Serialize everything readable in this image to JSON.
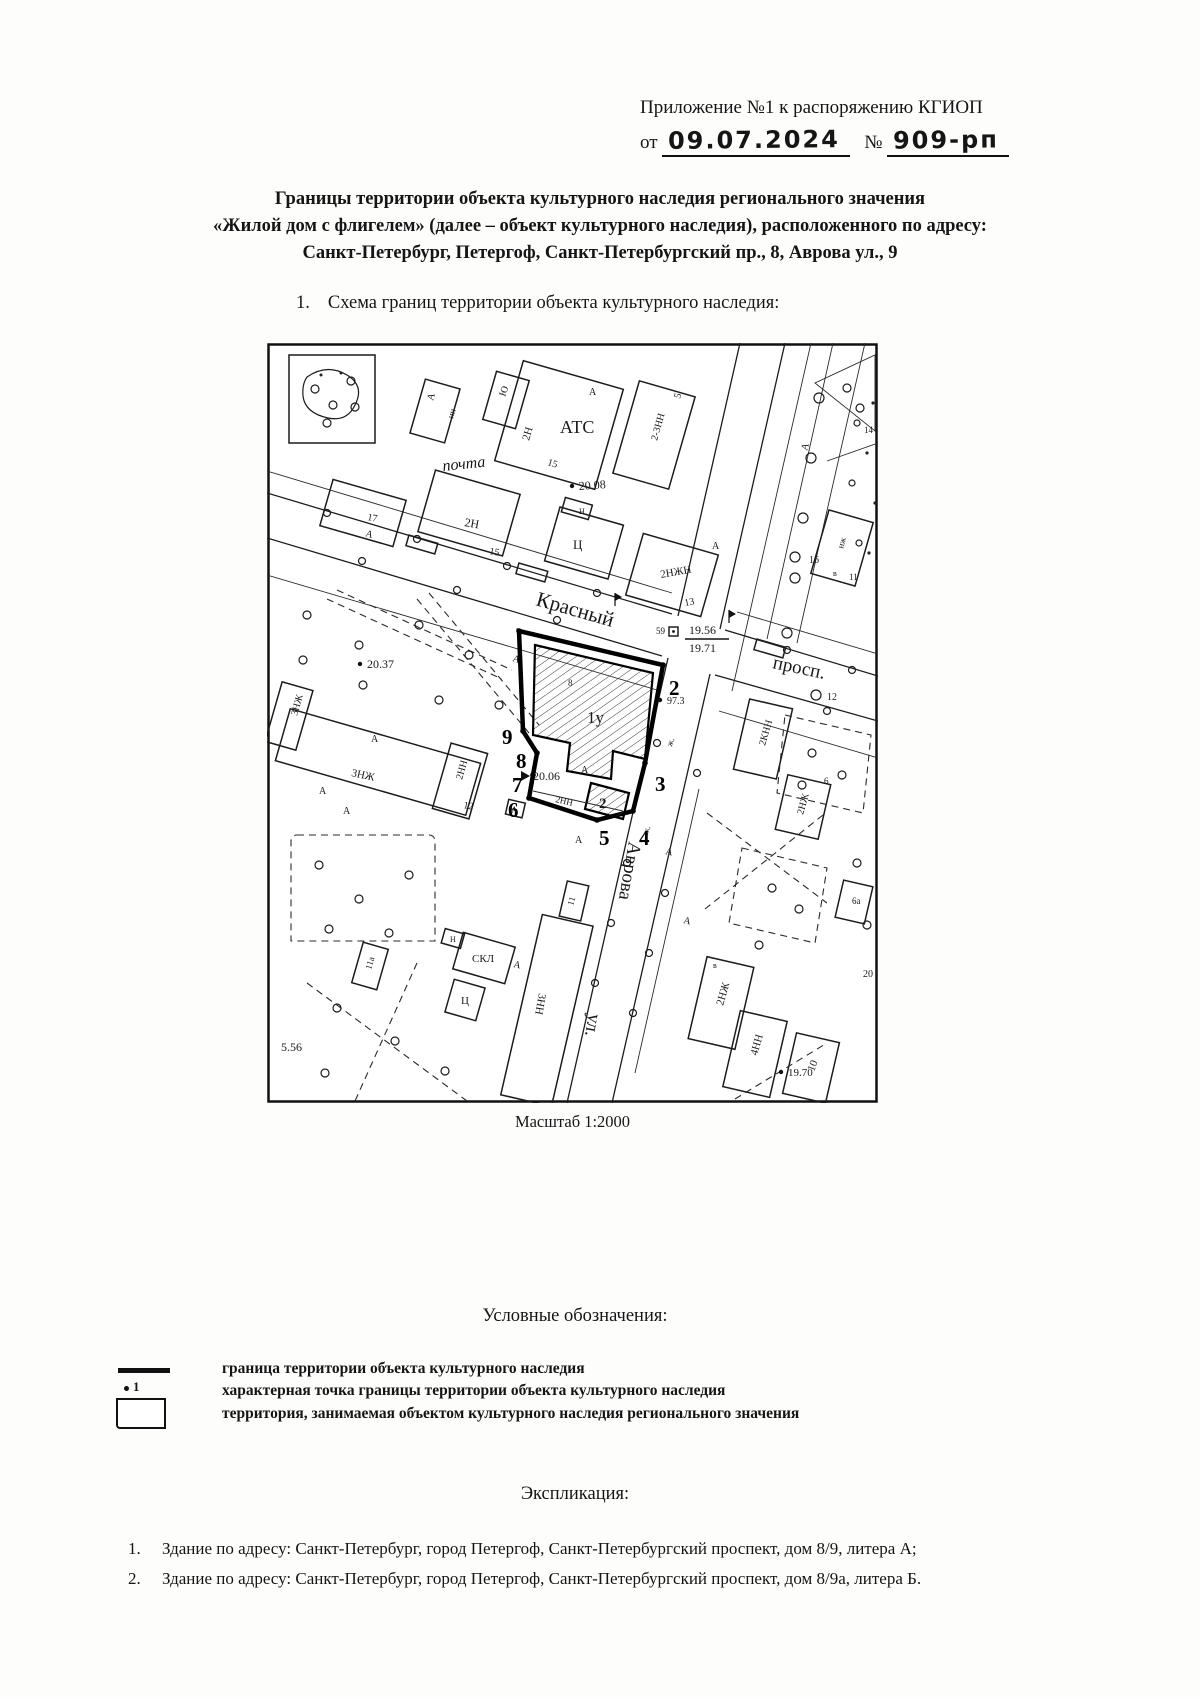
{
  "header": {
    "line1": "Приложение №1 к распоряжению КГИОП",
    "from_label": "от",
    "date_value": "09.07.2024",
    "number_label": "№",
    "number_value": "909-рп"
  },
  "title": {
    "line1": "Границы территории объекта культурного наследия регионального значения",
    "line2": "«Жилой дом с флигелем» (далее – объект культурного наследия), расположенного по адресу:",
    "line3": "Санкт-Петербург, Петергоф, Санкт-Петербургский пр., 8, Аврова ул., 9"
  },
  "section1": {
    "number": "1.",
    "text": "Схема границ территории объекта культурного наследия:"
  },
  "map": {
    "caption": "Масштаб 1:2000",
    "labels": [
      {
        "t": "Красный",
        "x": 268,
        "y": 262,
        "r": 16,
        "s": 21
      },
      {
        "t": "просп.",
        "x": 505,
        "y": 325,
        "r": 12,
        "s": 19
      },
      {
        "t": "Аврова",
        "x": 362,
        "y": 498,
        "r": 100,
        "s": 19
      },
      {
        "t": "ул.",
        "x": 322,
        "y": 670,
        "r": 100,
        "s": 19
      },
      {
        "t": "АТС",
        "x": 293,
        "y": 90,
        "s": 18
      },
      {
        "t": "почта",
        "x": 176,
        "y": 128,
        "r": -6,
        "s": 16,
        "i": true
      },
      {
        "t": "2Н",
        "x": 262,
        "y": 98,
        "r": -74,
        "s": 11
      },
      {
        "t": "А",
        "x": 322,
        "y": 52,
        "s": 10
      },
      {
        "t": "2-3НН",
        "x": 390,
        "y": 98,
        "r": -74,
        "s": 10
      },
      {
        "t": "5",
        "x": 413,
        "y": 56,
        "r": -74,
        "s": 10
      },
      {
        "t": "15",
        "x": 280,
        "y": 122,
        "r": 16,
        "s": 10
      },
      {
        "t": "20.08",
        "x": 312,
        "y": 147,
        "r": -4,
        "s": 12,
        "m": "dot"
      },
      {
        "t": "2Н",
        "x": 197,
        "y": 183,
        "r": 10,
        "s": 12
      },
      {
        "t": "15",
        "x": 222,
        "y": 211,
        "r": 10,
        "s": 10
      },
      {
        "t": "17",
        "x": 100,
        "y": 177,
        "r": 10,
        "s": 10
      },
      {
        "t": "Ю",
        "x": 238,
        "y": 54,
        "r": -70,
        "s": 10
      },
      {
        "t": "нн",
        "x": 186,
        "y": 76,
        "r": -74,
        "s": 9
      },
      {
        "t": "А",
        "x": 166,
        "y": 58,
        "r": -74,
        "s": 10
      },
      {
        "t": "Ц",
        "x": 306,
        "y": 206,
        "s": 13
      },
      {
        "t": "Н",
        "x": 312,
        "y": 171,
        "s": 8
      },
      {
        "t": "2НЖН",
        "x": 394,
        "y": 235,
        "r": -10,
        "s": 11
      },
      {
        "t": "13",
        "x": 418,
        "y": 263,
        "r": -10,
        "s": 10
      },
      {
        "t": "А",
        "x": 445,
        "y": 206,
        "s": 10
      },
      {
        "t": "14",
        "x": 597,
        "y": 90,
        "s": 9
      },
      {
        "t": "А",
        "x": 540,
        "y": 108,
        "r": -74,
        "s": 10
      },
      {
        "t": "нж",
        "x": 576,
        "y": 206,
        "r": -74,
        "s": 9
      },
      {
        "t": "в",
        "x": 566,
        "y": 233,
        "s": 8
      },
      {
        "t": "11",
        "x": 582,
        "y": 237,
        "s": 9
      },
      {
        "t": "16",
        "x": 542,
        "y": 220,
        "s": 10
      },
      {
        "t": "А",
        "x": 98,
        "y": 193,
        "r": 16,
        "s": 10
      },
      {
        "t": "А",
        "x": 245,
        "y": 318,
        "r": 16,
        "s": 10
      },
      {
        "t": "12",
        "x": 560,
        "y": 357,
        "s": 10
      },
      {
        "t": "2КНН",
        "x": 498,
        "y": 403,
        "r": -74,
        "s": 10
      },
      {
        "t": "2НЖ",
        "x": 536,
        "y": 472,
        "r": -74,
        "s": 10
      },
      {
        "t": "6",
        "x": 557,
        "y": 441,
        "s": 9
      },
      {
        "t": "6а",
        "x": 585,
        "y": 561,
        "s": 9
      },
      {
        "t": "2НЖ",
        "x": 456,
        "y": 663,
        "r": -74,
        "s": 11
      },
      {
        "t": "в",
        "x": 446,
        "y": 625,
        "s": 8
      },
      {
        "t": "4НН",
        "x": 490,
        "y": 713,
        "r": -74,
        "s": 11
      },
      {
        "t": "10",
        "x": 547,
        "y": 729,
        "r": -70,
        "s": 11
      },
      {
        "t": "19.70",
        "x": 521,
        "y": 733,
        "s": 11,
        "m": "dot"
      },
      {
        "t": "20",
        "x": 596,
        "y": 634,
        "s": 10
      },
      {
        "t": "А",
        "x": 416,
        "y": 580,
        "r": 12,
        "s": 10
      },
      {
        "t": "20.37",
        "x": 100,
        "y": 325,
        "s": 12,
        "m": "dot"
      },
      {
        "t": "3НЖ",
        "x": 30,
        "y": 373,
        "r": -74,
        "s": 10
      },
      {
        "t": "3НЖ",
        "x": 84,
        "y": 433,
        "r": 12,
        "s": 11
      },
      {
        "t": "2НН",
        "x": 195,
        "y": 437,
        "r": -74,
        "s": 10
      },
      {
        "t": "12",
        "x": 196,
        "y": 465,
        "r": 10,
        "s": 10
      },
      {
        "t": "А",
        "x": 104,
        "y": 399,
        "s": 10
      },
      {
        "t": "А",
        "x": 52,
        "y": 451,
        "s": 10
      },
      {
        "t": "А",
        "x": 76,
        "y": 471,
        "s": 10
      },
      {
        "t": "5.56",
        "x": 14,
        "y": 708,
        "s": 12
      },
      {
        "t": "СКЛ",
        "x": 205,
        "y": 619,
        "s": 11
      },
      {
        "t": "Н",
        "x": 183,
        "y": 599,
        "s": 8
      },
      {
        "t": "Ц",
        "x": 194,
        "y": 661,
        "s": 11
      },
      {
        "t": "11а",
        "x": 104,
        "y": 627,
        "r": -74,
        "s": 9
      },
      {
        "t": "3НН",
        "x": 272,
        "y": 650,
        "r": 100,
        "s": 11
      },
      {
        "t": "11",
        "x": 306,
        "y": 563,
        "r": -74,
        "s": 9
      },
      {
        "t": "А",
        "x": 246,
        "y": 624,
        "r": 12,
        "s": 10
      },
      {
        "t": "1у",
        "x": 320,
        "y": 380,
        "s": 17
      },
      {
        "t": "2",
        "x": 332,
        "y": 465,
        "s": 15,
        "b": true
      },
      {
        "t": "2НН",
        "x": 288,
        "y": 459,
        "r": 13,
        "s": 9
      },
      {
        "t": "20.06",
        "x": 266,
        "y": 437,
        "s": 12,
        "m": "tri"
      },
      {
        "t": "А",
        "x": 314,
        "y": 430,
        "s": 10
      },
      {
        "t": "А",
        "x": 308,
        "y": 500,
        "s": 10
      },
      {
        "t": "А",
        "x": 398,
        "y": 511,
        "r": 12,
        "s": 10
      },
      {
        "t": "ж.",
        "x": 381,
        "y": 492,
        "r": -74,
        "s": 9
      },
      {
        "t": "ж.",
        "x": 405,
        "y": 404,
        "r": -74,
        "s": 9
      },
      {
        "t": "А",
        "x": 244,
        "y": 470,
        "s": 9
      },
      {
        "t": "8",
        "x": 301,
        "y": 343,
        "s": 9
      },
      {
        "t": "97.3",
        "x": 400,
        "y": 361,
        "s": 10,
        "m": "dot"
      },
      {
        "t": "59",
        "x": 389,
        "y": 291,
        "s": 9
      },
      {
        "t": "19.56",
        "x": 422,
        "y": 291,
        "s": 12
      },
      {
        "t": "19.71",
        "x": 422,
        "y": 309,
        "s": 12
      }
    ],
    "points": [
      {
        "n": "2",
        "x": 402,
        "y": 352
      },
      {
        "n": "3",
        "x": 388,
        "y": 448
      },
      {
        "n": "4",
        "x": 372,
        "y": 502
      },
      {
        "n": "5",
        "x": 332,
        "y": 502
      },
      {
        "n": "6",
        "x": 241,
        "y": 474
      },
      {
        "n": "7",
        "x": 245,
        "y": 449
      },
      {
        "n": "8",
        "x": 249,
        "y": 425
      },
      {
        "n": "9",
        "x": 235,
        "y": 401
      }
    ]
  },
  "legend": {
    "title": "Условные обозначения:",
    "items": [
      {
        "symbol": "boundary-line",
        "text": "граница территории объекта культурного наследия"
      },
      {
        "symbol": "char-point",
        "symbol_label": "1",
        "text": "характерная точка границы территории объекта культурного наследия"
      },
      {
        "symbol": "territory-rect",
        "text": "территория, занимаемая объектом культурного наследия регионального значения"
      }
    ]
  },
  "explication": {
    "title": "Экспликация:",
    "items": [
      {
        "num": "1.",
        "text": "Здание по адресу: Санкт-Петербург, город Петергоф, Санкт-Петербургский проспект, дом 8/9, литера А;"
      },
      {
        "num": "2.",
        "text": "Здание по адресу: Санкт-Петербург, город Петергоф, Санкт-Петербургский проспект, дом 8/9а, литера Б."
      }
    ]
  }
}
